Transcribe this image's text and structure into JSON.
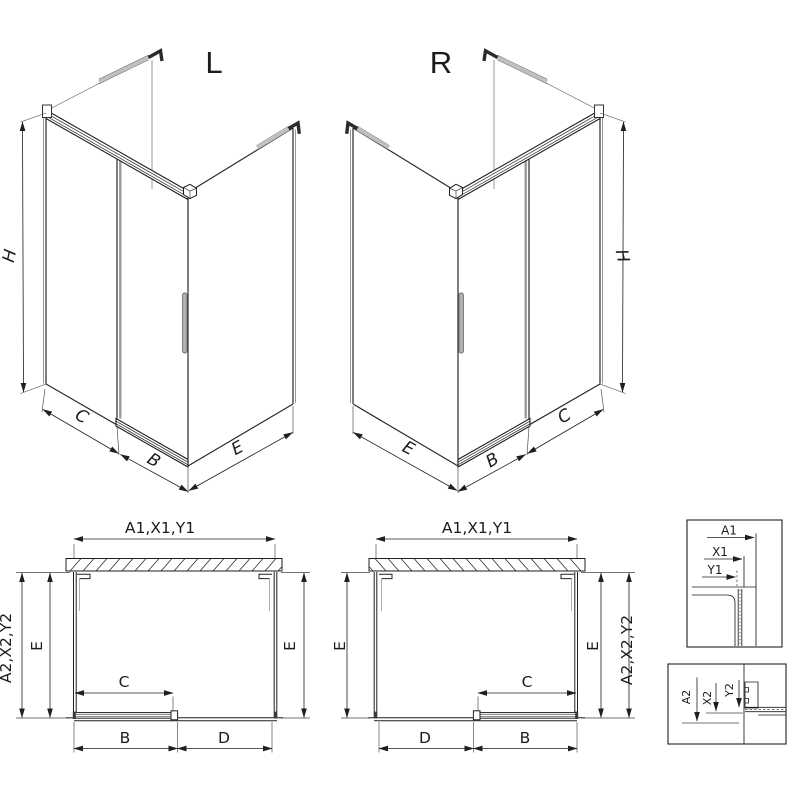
{
  "colors": {
    "line": "#1f1f1f",
    "profile_gray": "#9a9a9a",
    "handle_gray": "#b3b3b3",
    "background": "#ffffff"
  },
  "iso_left": {
    "title": "L",
    "dim_height": "H",
    "dim_side_panel": "C",
    "dim_door": "B",
    "dim_return_panel": "E"
  },
  "iso_right": {
    "title": "R",
    "dim_height": "H",
    "dim_side_panel": "C",
    "dim_door": "B",
    "dim_return_panel": "E"
  },
  "plan_left": {
    "dim_width_top": "A1,X1,Y1",
    "dim_depth_outer": "A2,X2,Y2",
    "dim_depth_left": "E",
    "dim_depth_right": "E",
    "dim_door_travel": "C",
    "dim_door_panel": "B",
    "dim_fixed_panel": "D"
  },
  "plan_right": {
    "dim_width_top": "A1,X1,Y1",
    "dim_depth_outer": "A2,X2,Y2",
    "dim_depth_left": "E",
    "dim_depth_right": "E",
    "dim_door_travel": "C",
    "dim_door_panel": "B",
    "dim_fixed_panel": "D"
  },
  "detail_upper": {
    "dim_a": "A1",
    "dim_x": "X1",
    "dim_y": "Y1"
  },
  "detail_lower": {
    "dim_a": "A2",
    "dim_x": "X2",
    "dim_y": "Y2"
  }
}
